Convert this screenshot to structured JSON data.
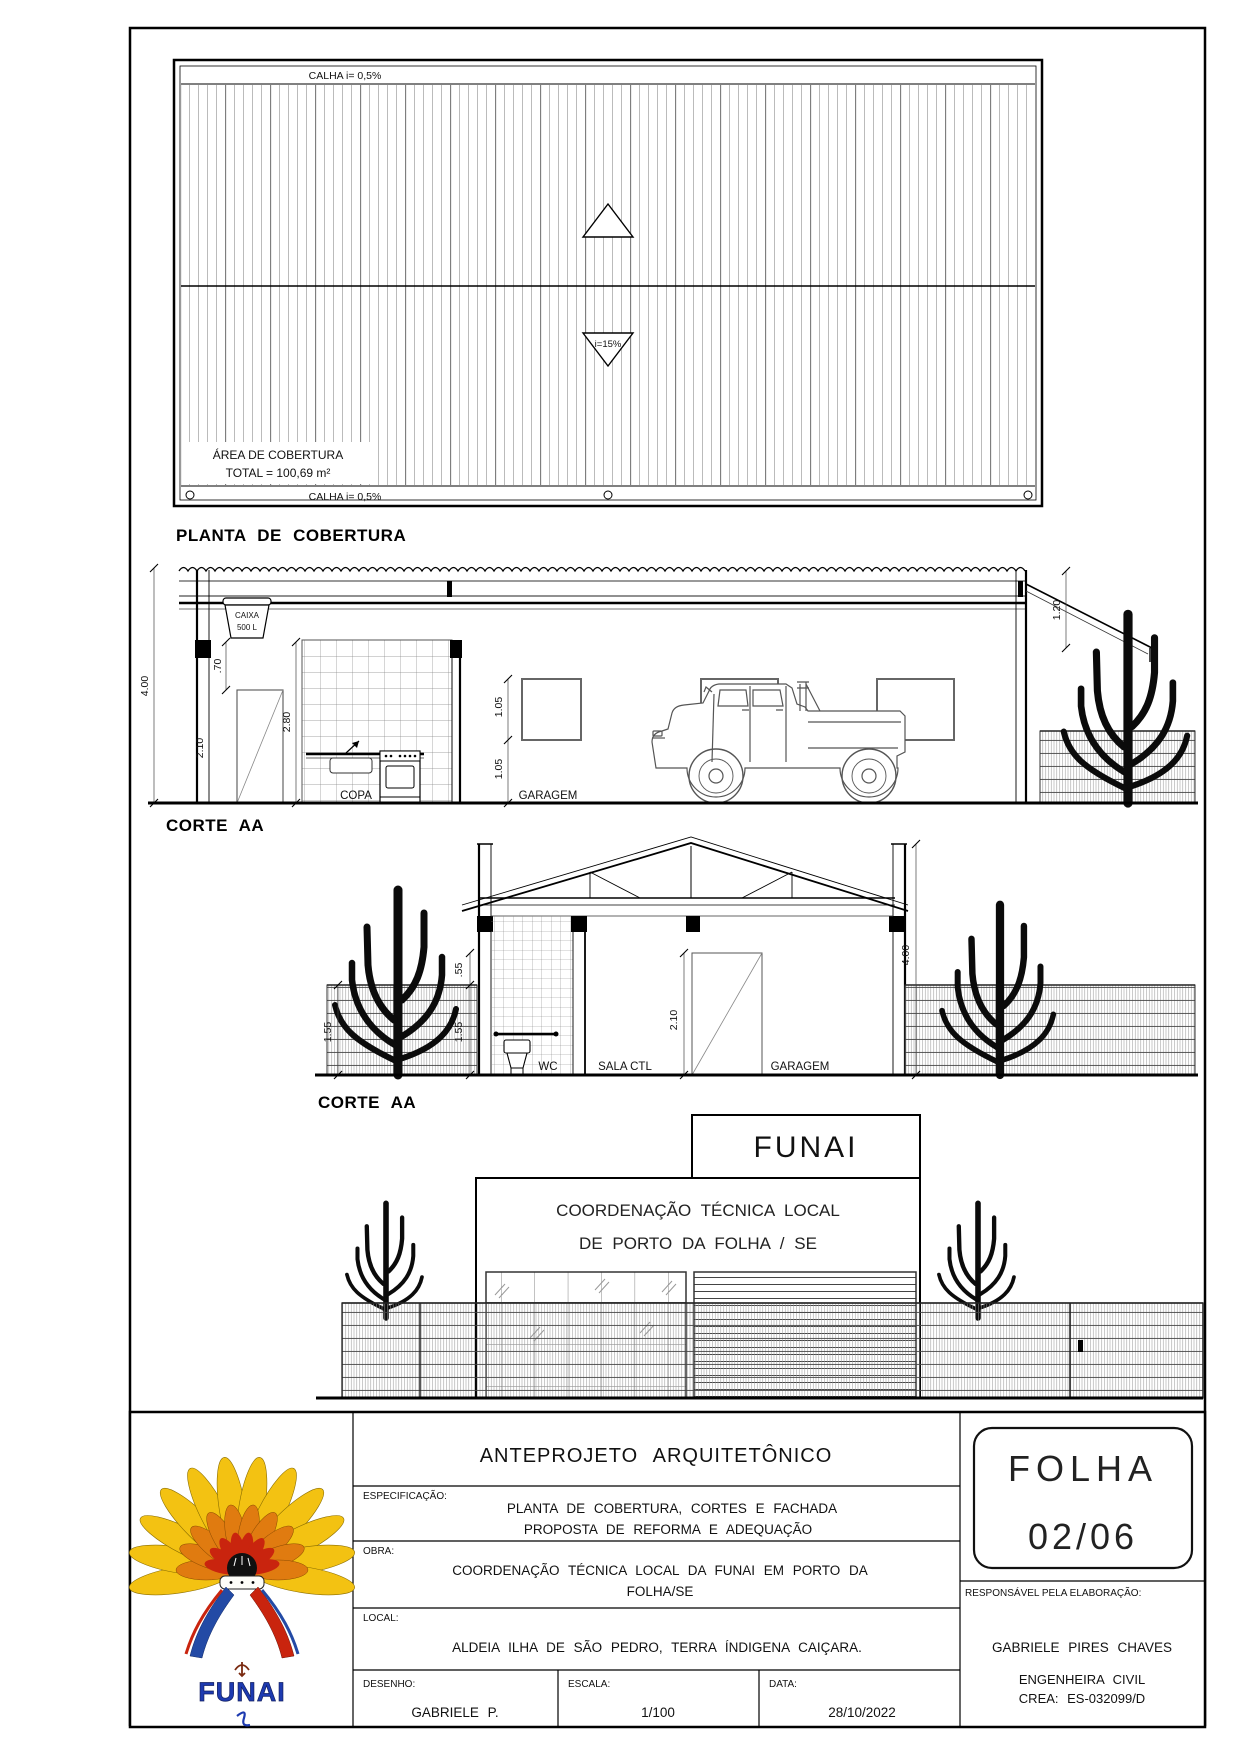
{
  "drawing": {
    "roof_plan": {
      "title": "PLANTA DE COBERTURA",
      "gutter_top": "CALHA i= 0,5%",
      "gutter_bottom": "CALHA i= 0,5%",
      "slope_label": "i=15%",
      "area_line1": "ÁREA DE COBERTURA",
      "area_line2": "TOTAL = 100,69 m²"
    },
    "section1": {
      "title": "CORTE AA",
      "tank_line1": "CAIXA",
      "tank_line2": "500 L",
      "room_copa": "COPA",
      "room_garagem": "GARAGEM",
      "dim_total_height": "4.00",
      "dim_beam": ".70",
      "dim_door": "2.10",
      "dim_ceiling": "2.80",
      "dim_window": "1.05",
      "dim_sill": "1.05",
      "dim_right_drop": "1.20"
    },
    "section2": {
      "title": "CORTE AA",
      "room_wc": "WC",
      "room_sala": "SALA CTL",
      "room_garagem": "GARAGEM",
      "dim_fence_left": "1.55",
      "dim_fence_right": "1.55",
      "dim_top_gap": ".55",
      "dim_door": "2.10",
      "dim_wall": "4.00"
    },
    "facade": {
      "sign": "FUNAI",
      "name_line1": "COORDENAÇÃO TÉCNICA LOCAL",
      "name_line2": "DE PORTO DA FOLHA / SE"
    }
  },
  "title_block": {
    "title": "ANTEPROJETO ARQUITETÔNICO",
    "espec_label": "ESPECIFICAÇÃO:",
    "espec_line1": "PLANTA DE COBERTURA, CORTES E FACHADA",
    "espec_line2": "PROPOSTA DE REFORMA E ADEQUAÇÃO",
    "obra_label": "OBRA:",
    "obra_line1": "COORDENAÇÃO TÉCNICA LOCAL DA FUNAI EM PORTO DA",
    "obra_line2": "FOLHA/SE",
    "local_label": "LOCAL:",
    "local_text": "ALDEIA ILHA DE SÃO PEDRO, TERRA ÍNDIGENA CAIÇARA.",
    "desenho_label": "DESENHO:",
    "desenho_value": "GABRIELE P.",
    "escala_label": "ESCALA:",
    "escala_value": "1/100",
    "data_label": "DATA:",
    "data_value": "28/10/2022",
    "folha_line1": "FOLHA",
    "folha_line2": "02/06",
    "resp_label": "RESPONSÁVEL PELA ELABORAÇÃO:",
    "resp_name": "GABRIELE PIRES CHAVES",
    "resp_role": "ENGENHEIRA CIVIL",
    "resp_crea": "CREA: ES-032099/D",
    "logo_text": "FUNAI"
  },
  "colors": {
    "line": "#000000",
    "logo_yellow": "#f3c212",
    "logo_orange": "#e07b10",
    "logo_red": "#c9240e",
    "logo_blue": "#1d3ab0"
  }
}
